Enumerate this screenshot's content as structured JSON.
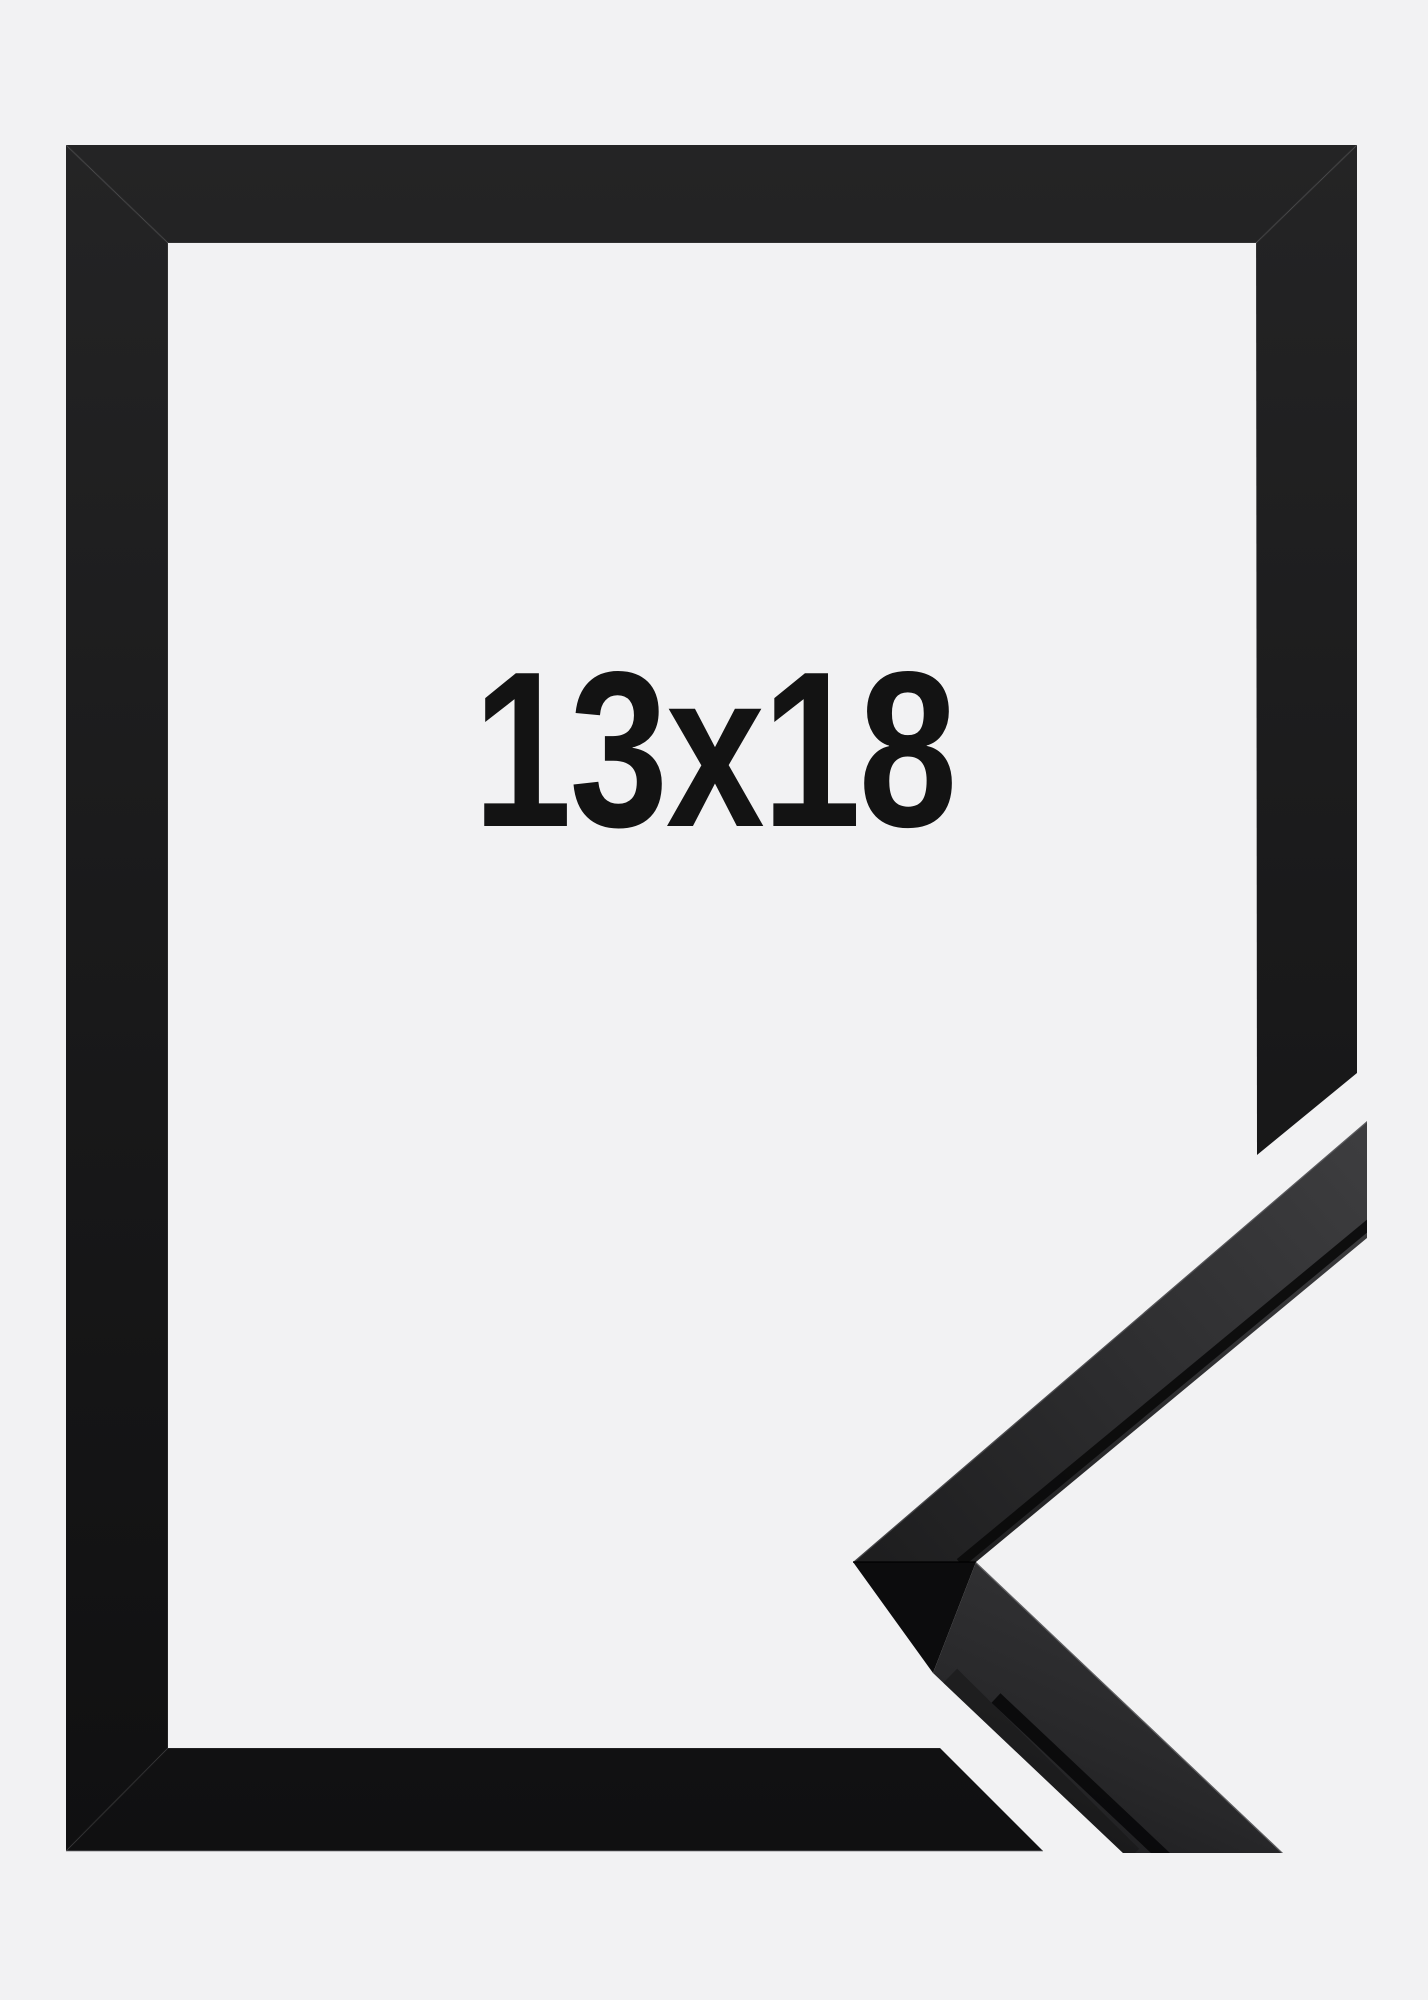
{
  "product_image": {
    "size_label": "13x18",
    "colors": {
      "background": "#f2f2f3",
      "frame_black_light": "#232324",
      "frame_black_dark": "#101011",
      "corner_face_light": "#3d3d3f",
      "corner_face_dark": "#1e1e1f",
      "corner_side_black": "#0b0b0c",
      "label_text": "#131313"
    }
  }
}
